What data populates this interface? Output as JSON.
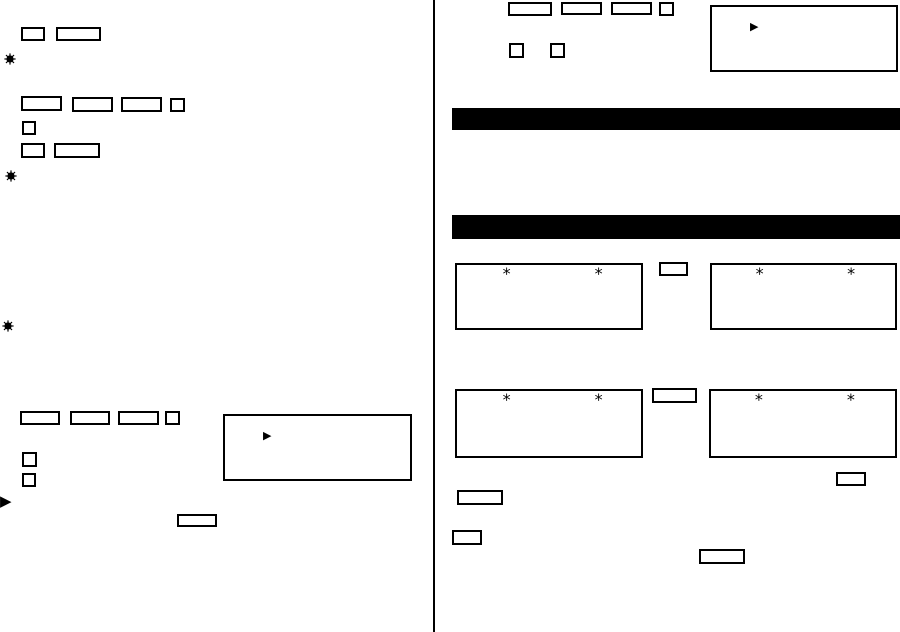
{
  "canvas": {
    "width": 900,
    "height": 632,
    "paper_color": "#ffffff",
    "ink_color": "#000000"
  },
  "marks": {
    "play_triangle": "▶",
    "asterisk": "*"
  },
  "icons": {
    "starburst": "black sunburst bullet",
    "play_triangle": "right-pointing filled triangle",
    "asterisk": "six-pointed asterisk mark"
  },
  "left_column": {
    "key_outline_count": 16,
    "starburst_bullet_count": 3,
    "callout_box_count": 1,
    "margin_triangle_count": 1
  },
  "right_column": {
    "key_outline_count": 12,
    "section_bar_count": 2,
    "display_box_count": 4,
    "display_box_asterisks_each": 2,
    "callout_box_count": 1
  }
}
